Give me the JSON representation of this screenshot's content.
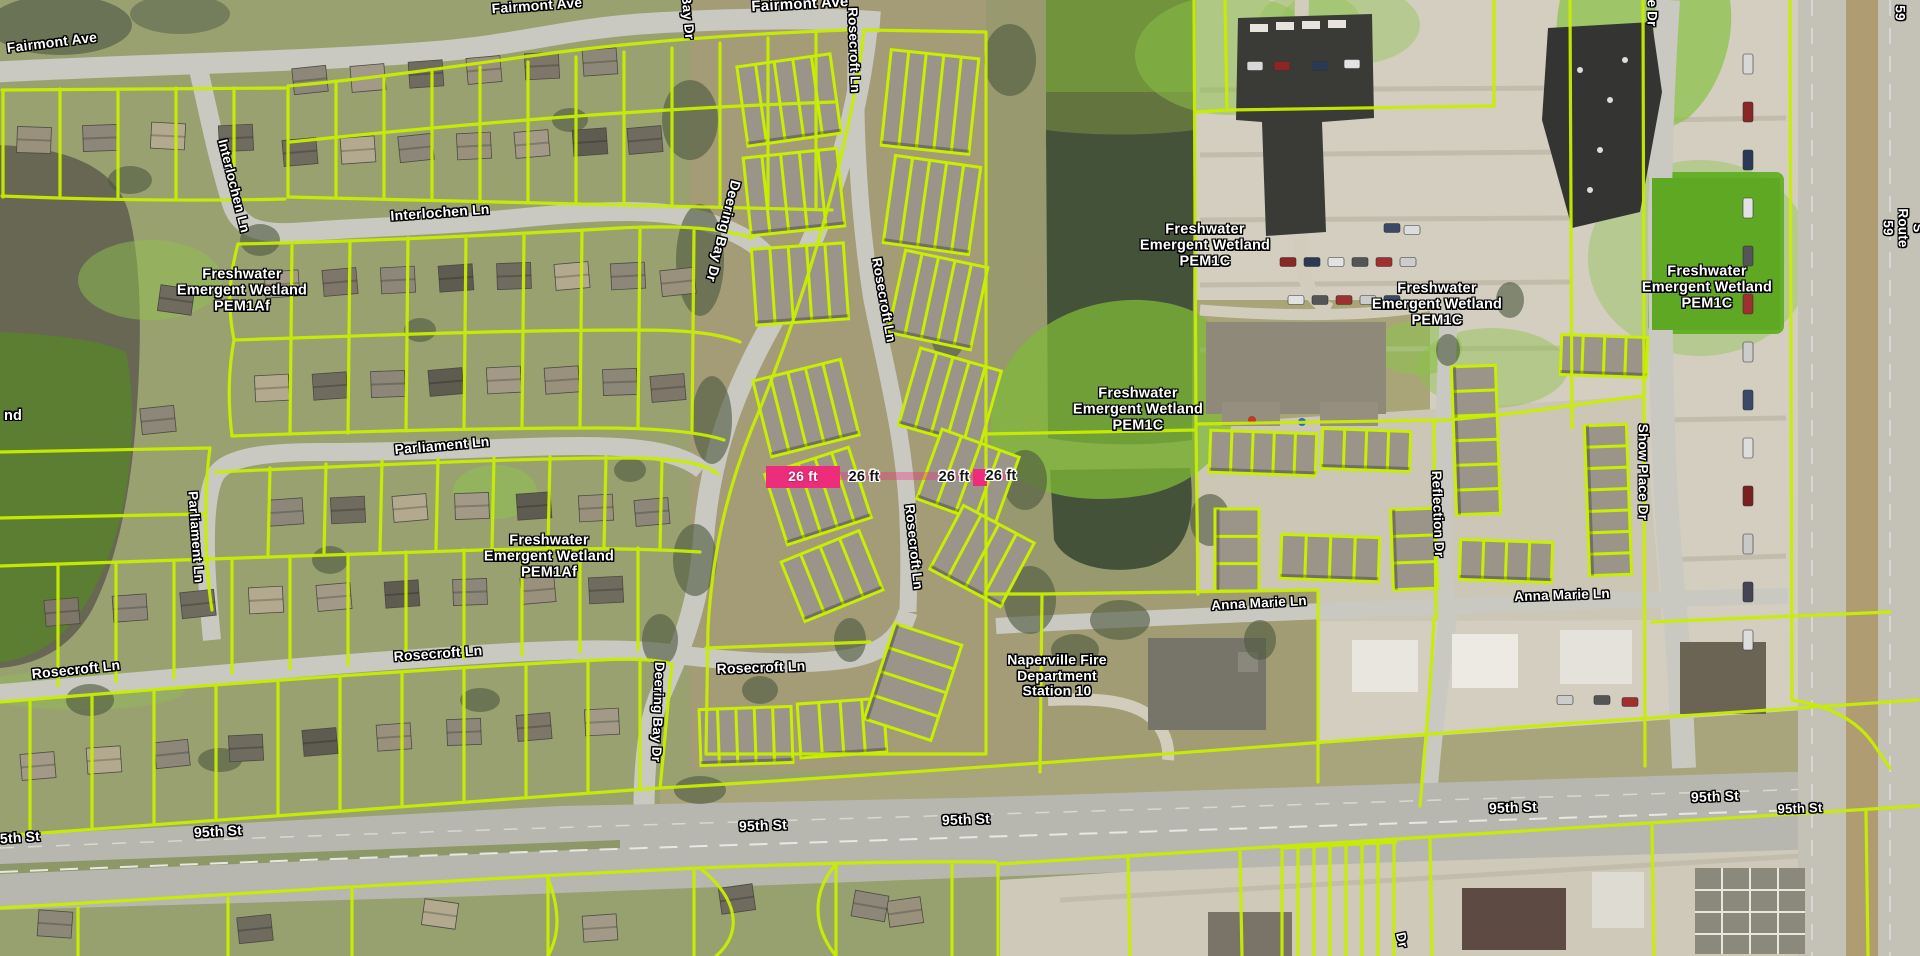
{
  "map": {
    "colors": {
      "parcel_line": "#c8ee00",
      "measurement_pink": "#ee2c7c",
      "wetland_overlay": "#7fba38",
      "wetland_solid": "#5c7f30",
      "water": "#44523a",
      "road_gray": "#c9c9c2",
      "label_text": "#ffffff",
      "label_halo": "#000000"
    },
    "street_labels": [
      {
        "text": "Fairmont Ave",
        "x": 52,
        "y": 43,
        "rot": -7,
        "size": 14
      },
      {
        "text": "Fairmont Ave",
        "x": 537,
        "y": 6,
        "rot": -4,
        "size": 14
      },
      {
        "text": "Fairmont Ave",
        "x": 800,
        "y": 5,
        "rot": -3,
        "size": 15
      },
      {
        "text": "Interlochen Ln",
        "x": 234,
        "y": 186,
        "rot": 76,
        "size": 13.5
      },
      {
        "text": "Interlochen Ln",
        "x": 440,
        "y": 213,
        "rot": -4,
        "size": 14
      },
      {
        "text": "Rosecroft Ln",
        "x": 854,
        "y": 50,
        "rot": 88,
        "size": 13.5
      },
      {
        "text": "Bay Dr",
        "x": 688,
        "y": 17,
        "rot": 85,
        "size": 13.5
      },
      {
        "text": "Deering Bay Dr",
        "x": 723,
        "y": 231,
        "rot": 104,
        "size": 14
      },
      {
        "text": "Rosecroft Ln",
        "x": 884,
        "y": 300,
        "rot": 80,
        "size": 13.5
      },
      {
        "text": "Rosecroft Ln",
        "x": 914,
        "y": 547,
        "rot": 84,
        "size": 13.5
      },
      {
        "text": "Deering Bay Dr",
        "x": 658,
        "y": 712,
        "rot": 92,
        "size": 13.5
      },
      {
        "text": "Parliament Ln",
        "x": 442,
        "y": 446,
        "rot": -5,
        "size": 14
      },
      {
        "text": "Parliament Ln",
        "x": 196,
        "y": 537,
        "rot": 86,
        "size": 13.5
      },
      {
        "text": "Rosecroft Ln",
        "x": 76,
        "y": 670,
        "rot": -6,
        "size": 14
      },
      {
        "text": "Rosecroft Ln",
        "x": 438,
        "y": 654,
        "rot": -4,
        "size": 14
      },
      {
        "text": "Rosecroft Ln",
        "x": 761,
        "y": 668,
        "rot": -2,
        "size": 14
      },
      {
        "text": "5th St",
        "x": 20,
        "y": 838,
        "rot": -4,
        "size": 14
      },
      {
        "text": "95th St",
        "x": 218,
        "y": 832,
        "rot": -3,
        "size": 14
      },
      {
        "text": "95th St",
        "x": 763,
        "y": 826,
        "rot": -2,
        "size": 14
      },
      {
        "text": "95th St",
        "x": 966,
        "y": 820,
        "rot": -2,
        "size": 14
      },
      {
        "text": "95th St",
        "x": 1513,
        "y": 808,
        "rot": -2,
        "size": 14
      },
      {
        "text": "95th St",
        "x": 1715,
        "y": 797,
        "rot": -2,
        "size": 14
      },
      {
        "text": "95th St",
        "x": 1800,
        "y": 809,
        "rot": -2,
        "size": 13
      },
      {
        "text": "Anna Marie Ln",
        "x": 1259,
        "y": 603,
        "rot": -3,
        "size": 13.5
      },
      {
        "text": "Anna Marie Ln",
        "x": 1562,
        "y": 595,
        "rot": -2,
        "size": 13.5
      },
      {
        "text": "Reflection Dr",
        "x": 1438,
        "y": 514,
        "rot": 88,
        "size": 13.5
      },
      {
        "text": "Show Place Dr",
        "x": 1643,
        "y": 472,
        "rot": 90,
        "size": 13.5
      },
      {
        "text": "e Dr",
        "x": 1652,
        "y": 13,
        "rot": 90,
        "size": 13.5
      },
      {
        "text": "S Route 59",
        "x": 1903,
        "y": 228,
        "rot": 90,
        "size": 13.5
      },
      {
        "text": "59",
        "x": 1900,
        "y": 13,
        "rot": 90,
        "size": 13.5
      },
      {
        "text": "Dr",
        "x": 1402,
        "y": 940,
        "rot": 78,
        "size": 13.5
      }
    ],
    "wetland_labels": [
      {
        "text": "Freshwater\nEmergent Wetland\nPEM1Af",
        "x": 242,
        "y": 291
      },
      {
        "text": "Freshwater\nEmergent Wetland\nPEM1Af",
        "x": 549,
        "y": 557
      },
      {
        "text": "Freshwater\nEmergent Wetland\nPEM1C",
        "x": 1138,
        "y": 410
      },
      {
        "text": "Freshwater\nEmergent Wetland\nPEM1C",
        "x": 1205,
        "y": 246
      },
      {
        "text": "Freshwater\nEmergent Wetland\nPEM1C",
        "x": 1437,
        "y": 305
      },
      {
        "text": "Freshwater\nEmergent Wetland\nPEM1C",
        "x": 1707,
        "y": 288
      },
      {
        "text": "nd",
        "x": 13,
        "y": 416
      }
    ],
    "poi_labels": [
      {
        "text": "Naperville Fire\nDepartment\nStation 10",
        "x": 1057,
        "y": 676
      }
    ],
    "measurement_labels": [
      {
        "kind": "pink-box",
        "text": "26 ft",
        "x": 766,
        "y": 466,
        "w": 74,
        "h": 22
      },
      {
        "kind": "halo",
        "text": "26 ft",
        "x": 864,
        "y": 477
      },
      {
        "kind": "halo",
        "text": "26 ft",
        "x": 954,
        "y": 477
      },
      {
        "kind": "pink-box",
        "text": "",
        "x": 973,
        "y": 469,
        "w": 14,
        "h": 17
      },
      {
        "kind": "halo",
        "text": "26 ft",
        "x": 1001,
        "y": 476
      }
    ]
  }
}
